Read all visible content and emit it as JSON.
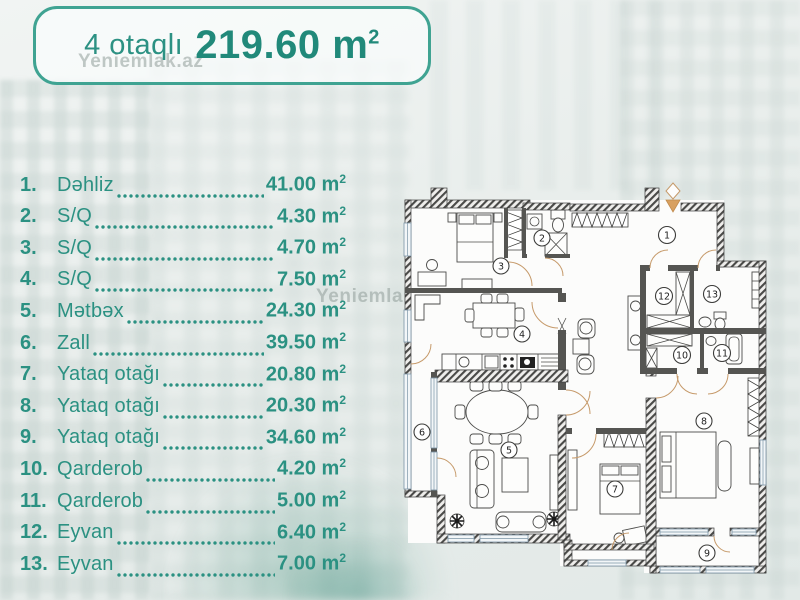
{
  "colors": {
    "accent": "#2b9182",
    "title_border": "#3fa392",
    "watermark": "#8f9d99",
    "plan_line": "#3d3d3c",
    "door_arc": "#c69a6a"
  },
  "header": {
    "rooms_label": "4 otaqlı",
    "area_value": "219.60",
    "unit_base": "m",
    "unit_sup": "2"
  },
  "watermark_text": "Yeniemlak.az",
  "rooms": [
    {
      "num": "1.",
      "name": "Dəhliz",
      "area": "41.00"
    },
    {
      "num": "2.",
      "name": "S/Q",
      "area": "4.30"
    },
    {
      "num": "3.",
      "name": "S/Q",
      "area": "4.70"
    },
    {
      "num": "4.",
      "name": "S/Q",
      "area": "7.50"
    },
    {
      "num": "5.",
      "name": "Mətbəx",
      "area": "24.30"
    },
    {
      "num": "6.",
      "name": "Zall",
      "area": "39.50"
    },
    {
      "num": "7.",
      "name": "Yataq otağı",
      "area": "20.80"
    },
    {
      "num": "8.",
      "name": "Yataq otağı",
      "area": "20.30"
    },
    {
      "num": "9.",
      "name": "Yataq otağı",
      "area": "34.60"
    },
    {
      "num": "10.",
      "name": "Qarderob",
      "area": "4.20"
    },
    {
      "num": "11.",
      "name": "Qarderob",
      "area": "5.00"
    },
    {
      "num": "12.",
      "name": "Eyvan",
      "area": "6.40"
    },
    {
      "num": "13.",
      "name": "Eyvan",
      "area": "7.00"
    }
  ],
  "plan": {
    "numbers": [
      "1",
      "2",
      "3",
      "4",
      "5",
      "6",
      "7",
      "8",
      "9",
      "10",
      "11",
      "12",
      "13"
    ]
  }
}
